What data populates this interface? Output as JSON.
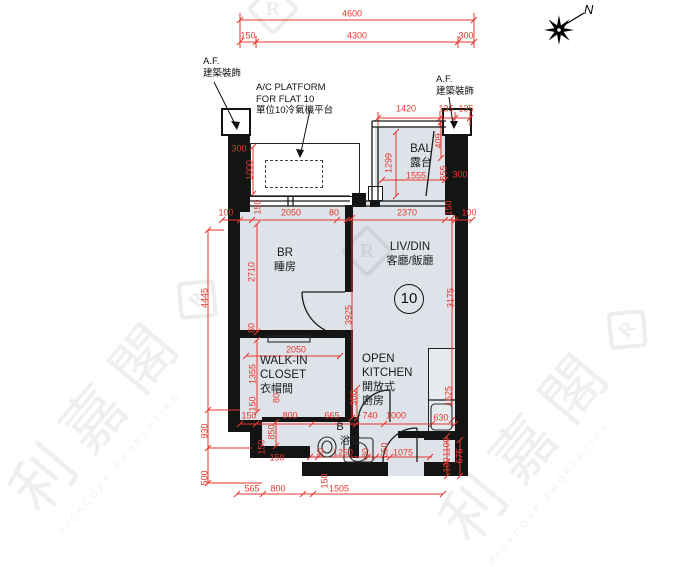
{
  "compass": {
    "label": "N"
  },
  "watermark": {
    "cn": "利嘉閣",
    "en": "RICACORP PROPERTIES",
    "logo_letter": "R"
  },
  "colors": {
    "dimension_red": "#e8362e",
    "room_fill": "#dde3e8",
    "wall_black": "#141414"
  },
  "annotations": {
    "af_left": {
      "line1": "A.F.",
      "line2": "建築裝飾"
    },
    "af_right": {
      "line1": "A.F.",
      "line2": "建築裝飾"
    },
    "ac_platform": {
      "line1": "A/C PLATFORM",
      "line2": "FOR FLAT 10",
      "line3": "單位10冷氣機平台"
    }
  },
  "rooms": {
    "br": {
      "en": "BR",
      "cn": "睡房"
    },
    "livdin": {
      "en": "LIV/DIN",
      "cn": "客廳/飯廳"
    },
    "closet": {
      "en1": "WALK-IN",
      "en2": "CLOSET",
      "cn": "衣帽間"
    },
    "kitchen": {
      "en1": "OPEN",
      "en2": "KITCHEN",
      "cn1": "開放式",
      "cn2": "廚房"
    },
    "bal": {
      "en": "BAL",
      "cn": "露台"
    },
    "bath": {
      "en": "B",
      "cn": "浴室"
    },
    "unit_number": "10"
  },
  "dims": [
    {
      "t": "4600",
      "x": 352,
      "y": 14
    },
    {
      "t": "150",
      "x": 248,
      "y": 36
    },
    {
      "t": "4300",
      "x": 357,
      "y": 36
    },
    {
      "t": "300",
      "x": 466,
      "y": 36
    },
    {
      "t": "1420",
      "x": 406,
      "y": 109
    },
    {
      "t": "135",
      "x": 446,
      "y": 109
    },
    {
      "t": "135",
      "x": 466,
      "y": 109
    },
    {
      "t": "300",
      "x": 239,
      "y": 149
    },
    {
      "t": "1000",
      "x": 250,
      "y": 170,
      "r": 1
    },
    {
      "t": "1299",
      "x": 389,
      "y": 163,
      "r": 1
    },
    {
      "t": "1555",
      "x": 416,
      "y": 176
    },
    {
      "t": "409",
      "x": 439,
      "y": 141,
      "r": 1
    },
    {
      "t": "655",
      "x": 444,
      "y": 173,
      "r": 1
    },
    {
      "t": "300",
      "x": 460,
      "y": 175
    },
    {
      "t": "100",
      "x": 226,
      "y": 213
    },
    {
      "t": "150",
      "x": 258,
      "y": 207,
      "r": 1
    },
    {
      "t": "2050",
      "x": 291,
      "y": 213
    },
    {
      "t": "80",
      "x": 334,
      "y": 213
    },
    {
      "t": "2370",
      "x": 407,
      "y": 213
    },
    {
      "t": "150",
      "x": 449,
      "y": 208,
      "r": 1
    },
    {
      "t": "100",
      "x": 469,
      "y": 213
    },
    {
      "t": "4445",
      "x": 205,
      "y": 298,
      "r": 1
    },
    {
      "t": "2710",
      "x": 252,
      "y": 272,
      "r": 1
    },
    {
      "t": "80",
      "x": 252,
      "y": 328,
      "r": 1
    },
    {
      "t": "3925",
      "x": 349,
      "y": 315,
      "r": 1
    },
    {
      "t": "3175",
      "x": 451,
      "y": 298,
      "r": 1
    },
    {
      "t": "2050",
      "x": 296,
      "y": 350
    },
    {
      "t": "1355",
      "x": 253,
      "y": 374,
      "r": 1
    },
    {
      "t": "150",
      "x": 253,
      "y": 404,
      "r": 1
    },
    {
      "t": "80",
      "x": 277,
      "y": 398,
      "r": 1
    },
    {
      "t": "300",
      "x": 354,
      "y": 398,
      "r": 1
    },
    {
      "t": "150",
      "x": 249,
      "y": 416
    },
    {
      "t": "800",
      "x": 290,
      "y": 416
    },
    {
      "t": "665",
      "x": 332,
      "y": 416
    },
    {
      "t": "740",
      "x": 370,
      "y": 416
    },
    {
      "t": "1000",
      "x": 396,
      "y": 416
    },
    {
      "t": "1625",
      "x": 449,
      "y": 396,
      "r": 1
    },
    {
      "t": "630",
      "x": 441,
      "y": 418
    },
    {
      "t": "850",
      "x": 272,
      "y": 432,
      "r": 1
    },
    {
      "t": "150",
      "x": 262,
      "y": 447,
      "r": 1
    },
    {
      "t": "150",
      "x": 277,
      "y": 458
    },
    {
      "t": "80",
      "x": 321,
      "y": 453,
      "r": 1
    },
    {
      "t": "1250",
      "x": 343,
      "y": 453
    },
    {
      "t": "80",
      "x": 366,
      "y": 453,
      "r": 1
    },
    {
      "t": "650",
      "x": 385,
      "y": 450,
      "r": 1
    },
    {
      "t": "1075",
      "x": 403,
      "y": 453
    },
    {
      "t": "1100",
      "x": 447,
      "y": 447,
      "r": 1
    },
    {
      "t": "100",
      "x": 447,
      "y": 465,
      "r": 1
    },
    {
      "t": "675",
      "x": 460,
      "y": 456,
      "r": 1
    },
    {
      "t": "930",
      "x": 205,
      "y": 431,
      "r": 1
    },
    {
      "t": "500",
      "x": 205,
      "y": 478,
      "r": 1
    },
    {
      "t": "150",
      "x": 325,
      "y": 481,
      "r": 1
    },
    {
      "t": "565",
      "x": 252,
      "y": 489
    },
    {
      "t": "800",
      "x": 278,
      "y": 489
    },
    {
      "t": "1505",
      "x": 339,
      "y": 489
    }
  ]
}
